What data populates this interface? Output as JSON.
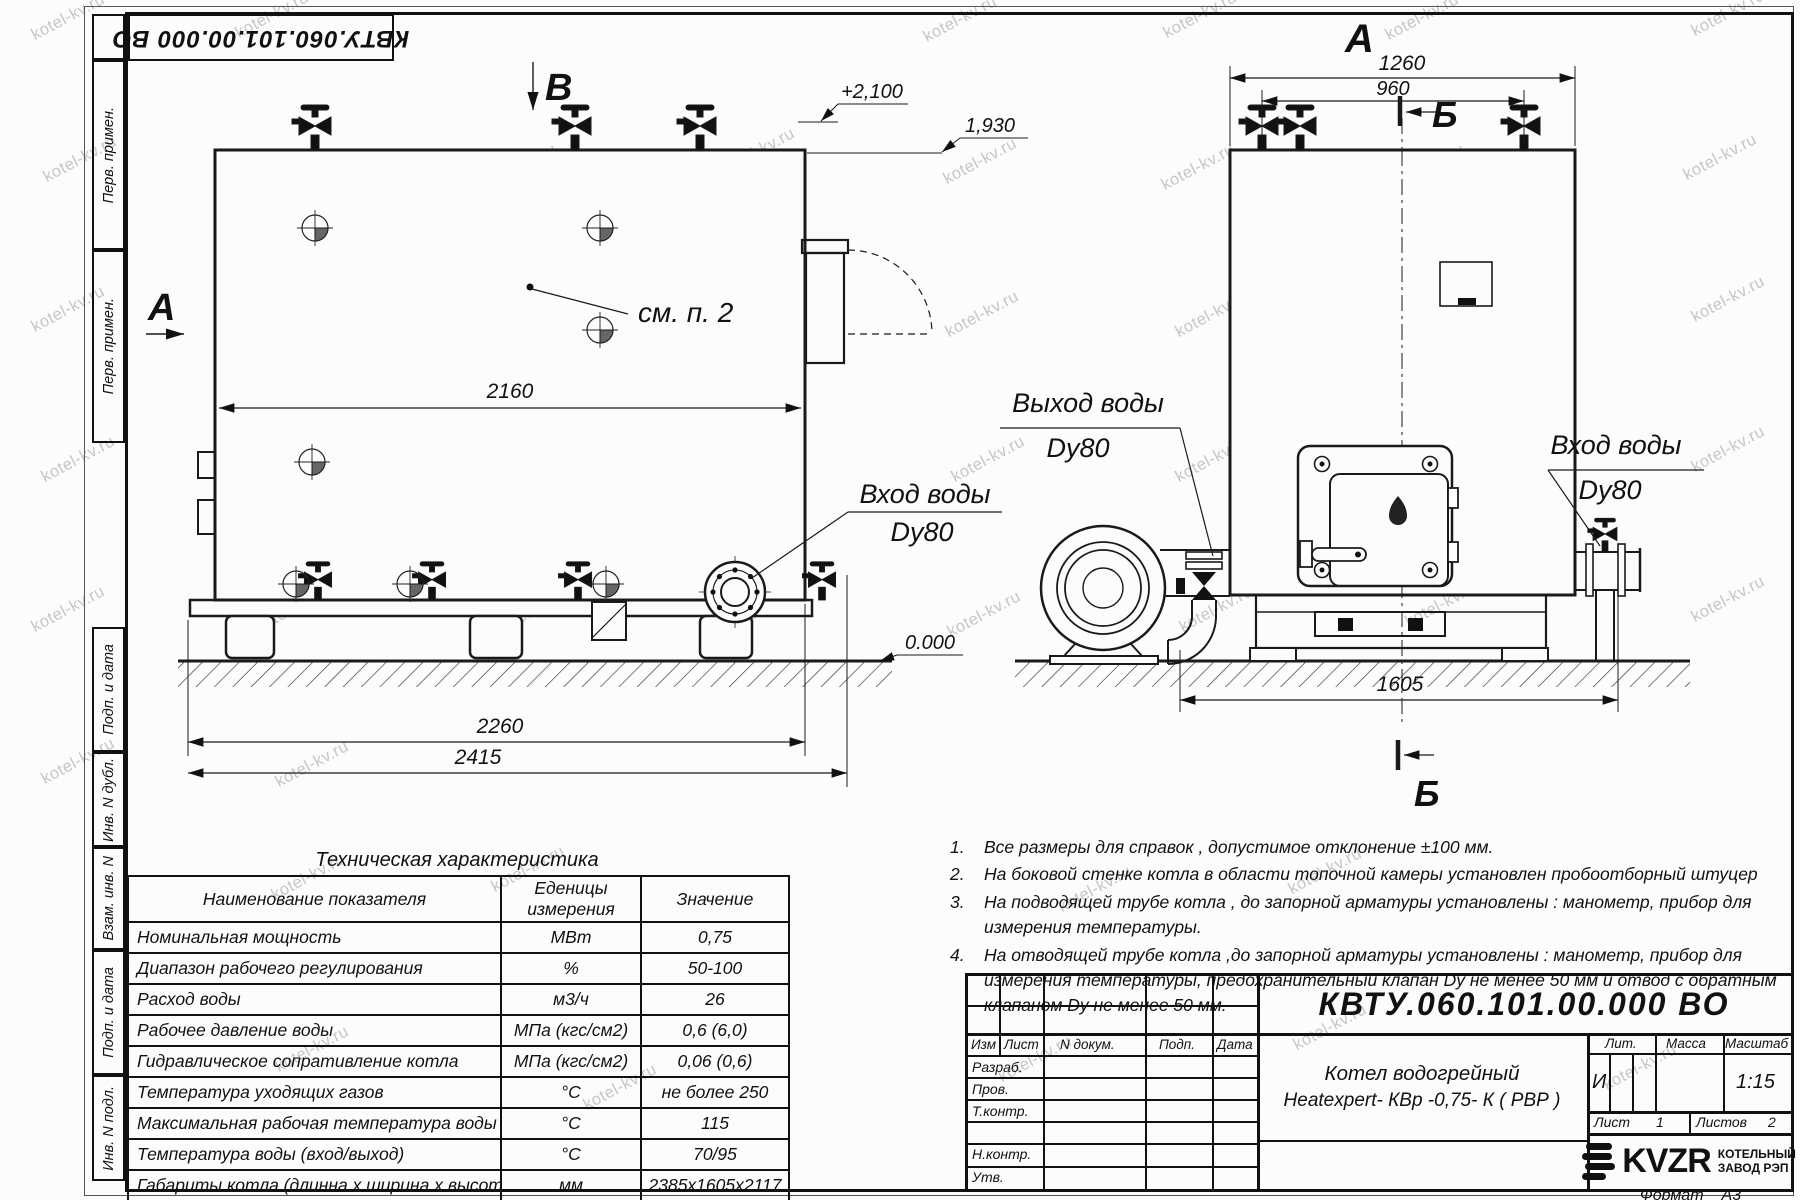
{
  "watermark": {
    "text": "kotel-kv.ru"
  },
  "stamp_top_left": {
    "designation": "КВТУ.060.101.00.000  ВО"
  },
  "side_strips": {
    "items": [
      "Перв. примен.",
      "Перв. примен.",
      "Подп. и дата",
      "Инв. N дубл.",
      "Взам. инв. N",
      "Подп. и дата",
      "Инв. N подл."
    ]
  },
  "views": {
    "left": {
      "section_b_label": "В",
      "section_a_label": "А",
      "elevation_top": "+2,100",
      "elevation_mid": "1,930",
      "elevation_zero": "0.000",
      "see_note": "см. п. 2",
      "dim_width_inner": "2160",
      "dim_base": "2260",
      "dim_total": "2415",
      "inlet_label_line1": "Вход воды",
      "inlet_label_line2": "Dy80"
    },
    "right": {
      "view_label": "А",
      "section_label_top": "Б",
      "section_label_bottom": "Б",
      "dim_top1": "1260",
      "dim_top2": "960",
      "dim_bottom": "1605",
      "outlet_label_line1": "Выход воды",
      "outlet_label_line2": "Dy80",
      "inlet_label_line1": "Вход воды",
      "inlet_label_line2": "Dy80"
    }
  },
  "spec_table": {
    "title": "Техническая характеристика",
    "headers": {
      "name": "Наименование показателя",
      "unit1": "Еденицы",
      "unit2": "измерения",
      "value": "Значение"
    },
    "rows": [
      [
        "Номинальная мощность",
        "МВт",
        "0,75"
      ],
      [
        "Диапазон рабочего регулирования",
        "%",
        "50-100"
      ],
      [
        "Расход воды",
        "м3/ч",
        "26"
      ],
      [
        "Рабочее давление воды",
        "МПа (кгс/см2)",
        "0,6 (6,0)"
      ],
      [
        "Гидравлическое сопративление котла",
        "МПа (кгс/см2)",
        "0,06 (0,6)"
      ],
      [
        "Температура уходящих газов",
        "°С",
        "не более 250"
      ],
      [
        "Максимальная рабочая температура воды",
        "°С",
        "115"
      ],
      [
        "Температура воды (вход/выход)",
        "°С",
        "70/95"
      ],
      [
        "Габариты котла (длинна х ширина х высота)",
        "мм",
        "2385х1605х2117"
      ]
    ]
  },
  "notes": {
    "items": [
      {
        "n": "1.",
        "t": "Все размеры для справок , допустимое отклонение  ±100 мм."
      },
      {
        "n": "2.",
        "t": "На боковой стенке котла в области топочной камеры установлен пробоотборный штуцер"
      },
      {
        "n": "3.",
        "t": "На   подводящей трубе котла , до запорной арматуры установлены : манометр, прибор для измерения температуры."
      },
      {
        "n": "4.",
        "t": "На отводящей трубе котла ,до запорной арматуры установлены : манометр, прибор для измерения температуры, предохранительный клапан  Dy не менее  50 мм и отвод с обратным клапаном  Dy не менее  50 мм."
      }
    ]
  },
  "title_block": {
    "designation": "КВТУ.060.101.00.000  ВО",
    "doc_name_line1": "Котел водогрейный",
    "doc_name_line2": "Heatexpert- КВр -0,75- К ( РВР )",
    "header_cols": [
      "Изм",
      "Лист",
      "N докум.",
      "Подп.",
      "Дата"
    ],
    "row_labels": [
      "Разраб.",
      "Пров.",
      "Т.контр.",
      "Н.контр.",
      "Утв."
    ],
    "lit_label": "Лит.",
    "lit_value": "И",
    "mass_label": "Масса",
    "scale_label": "Масштаб",
    "scale_value": "1:15",
    "sheet_label": "Лист",
    "sheet_value": "1",
    "sheets_label": "Листов",
    "sheets_value": "2",
    "company": {
      "logo": "KVZR",
      "line1": "КОТЕЛЬНЫЙ",
      "line2": "ЗАВОД РЭП"
    },
    "format_label": "Формат",
    "format_value": "А3"
  }
}
